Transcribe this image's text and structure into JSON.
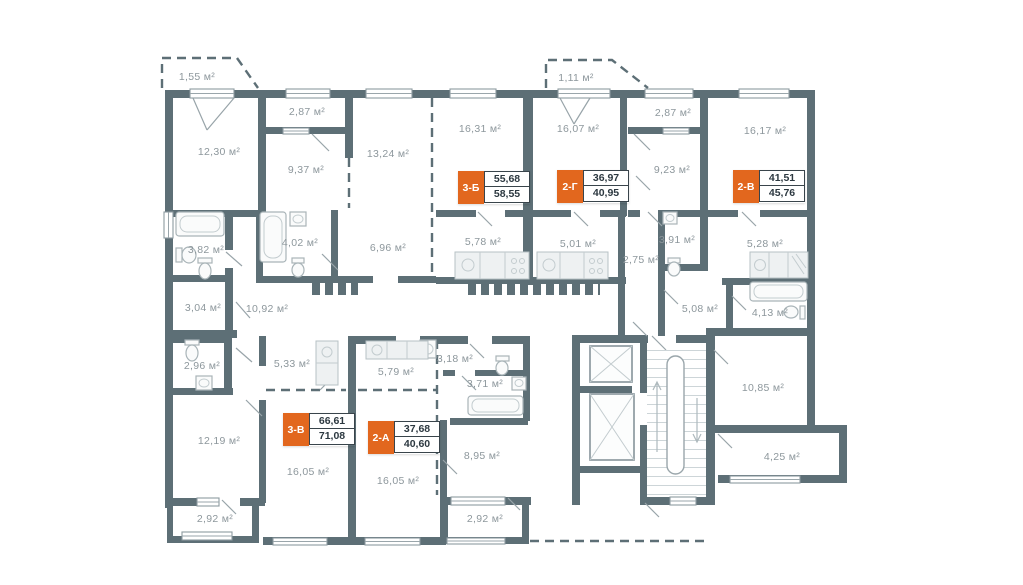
{
  "plan": {
    "title": "Floor plan",
    "unit_suffix": "м²",
    "colors": {
      "wall": "#5d6f76",
      "orange": "#e2671e",
      "label": "#8d979c",
      "badge_border": "#39444b",
      "badge_text": "#2c3840"
    },
    "apartments": [
      {
        "code": "3-Б",
        "area_living": "55,68",
        "area_total": "58,55"
      },
      {
        "code": "2-Г",
        "area_living": "36,97",
        "area_total": "40,95"
      },
      {
        "code": "2-В",
        "area_living": "41,51",
        "area_total": "45,76"
      },
      {
        "code": "3-В",
        "area_living": "66,61",
        "area_total": "71,08"
      },
      {
        "code": "2-А",
        "area_living": "37,68",
        "area_total": "40,60"
      }
    ],
    "rooms": [
      {
        "id": "balcony-a",
        "area": "1,55 м²"
      },
      {
        "id": "wardrobe-a",
        "area": "2,87 м²"
      },
      {
        "id": "room-12-30",
        "area": "12,30 м²"
      },
      {
        "id": "room-9-37",
        "area": "9,37 м²"
      },
      {
        "id": "room-13-24",
        "area": "13,24 м²"
      },
      {
        "id": "room-16-31",
        "area": "16,31 м²"
      },
      {
        "id": "balcony-b",
        "area": "1,11 м²"
      },
      {
        "id": "room-16-07",
        "area": "16,07 м²"
      },
      {
        "id": "wardrobe-b",
        "area": "2,87 м²"
      },
      {
        "id": "room-16-17",
        "area": "16,17 м²"
      },
      {
        "id": "room-9-23",
        "area": "9,23 м²"
      },
      {
        "id": "bath-3-82",
        "area": "3,82 м²"
      },
      {
        "id": "bath-4-02",
        "area": "4,02 м²"
      },
      {
        "id": "hall-6-96",
        "area": "6,96 м²"
      },
      {
        "id": "kitchen-5-78",
        "area": "5,78 м²"
      },
      {
        "id": "kitchen-5-01",
        "area": "5,01 м²"
      },
      {
        "id": "hall-2-75",
        "area": "2,75 м²"
      },
      {
        "id": "bath-3-91",
        "area": "3,91 м²"
      },
      {
        "id": "kitchen-5-28",
        "area": "5,28 м²"
      },
      {
        "id": "wc-3-04",
        "area": "3,04 м²"
      },
      {
        "id": "hall-10-92",
        "area": "10,92 м²"
      },
      {
        "id": "hall-5-08",
        "area": "5,08 м²"
      },
      {
        "id": "bath-4-13",
        "area": "4,13 м²"
      },
      {
        "id": "wc-2-96",
        "area": "2,96 м²"
      },
      {
        "id": "hall-5-33",
        "area": "5,33 м²"
      },
      {
        "id": "hall-3-18",
        "area": "3,18 м²"
      },
      {
        "id": "bath-3-71",
        "area": "3,71 м²"
      },
      {
        "id": "kitchen-5-79",
        "area": "5,79 м²"
      },
      {
        "id": "room-10-85",
        "area": "10,85 м²"
      },
      {
        "id": "room-12-19",
        "area": "12,19 м²"
      },
      {
        "id": "room-16-05-a",
        "area": "16,05 м²"
      },
      {
        "id": "room-16-05-b",
        "area": "16,05 м²"
      },
      {
        "id": "room-8-95",
        "area": "8,95 м²"
      },
      {
        "id": "balcony-4-25",
        "area": "4,25 м²"
      },
      {
        "id": "loggia-a",
        "area": "2,92 м²"
      },
      {
        "id": "loggia-b",
        "area": "2,92 м²"
      }
    ]
  }
}
